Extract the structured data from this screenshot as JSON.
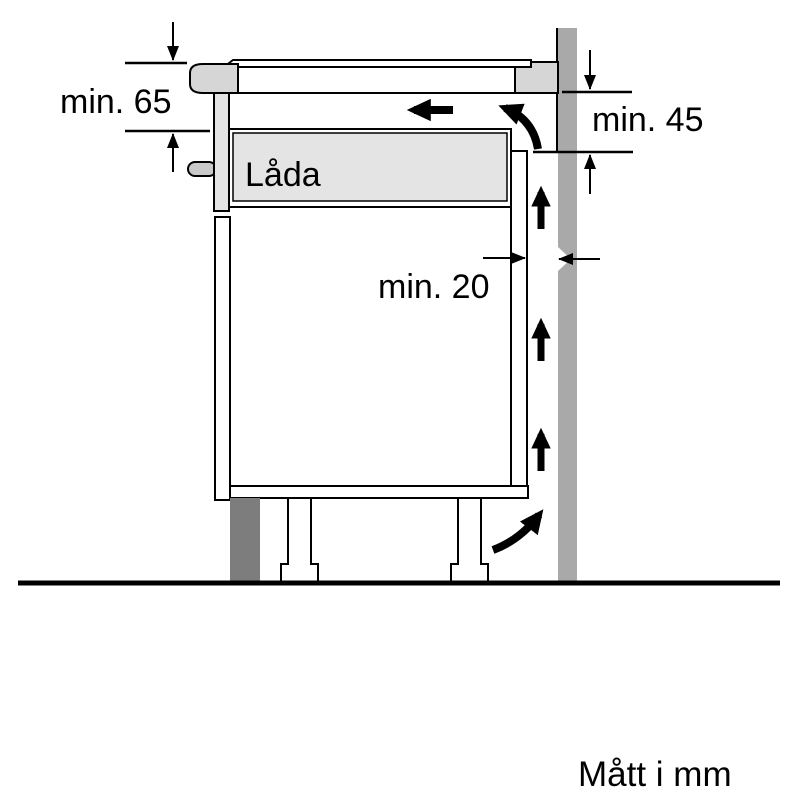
{
  "diagram": {
    "drawer_label": "Låda",
    "units_note": "Mått i mm",
    "dimensions": {
      "hob_top_to_drawer": "min. 65",
      "worktop_to_rear_panel": "min. 45",
      "cabinet_to_wall_gap": "min. 20"
    },
    "colors": {
      "wall": "#a9a9a9",
      "worktop_section": "#d6d6d6",
      "drawer": "#e4e4e4",
      "fascia": "#e4e4e4",
      "handle": "#c9c9c9",
      "plinth": "#7d7d7d",
      "line": "#000000"
    }
  }
}
